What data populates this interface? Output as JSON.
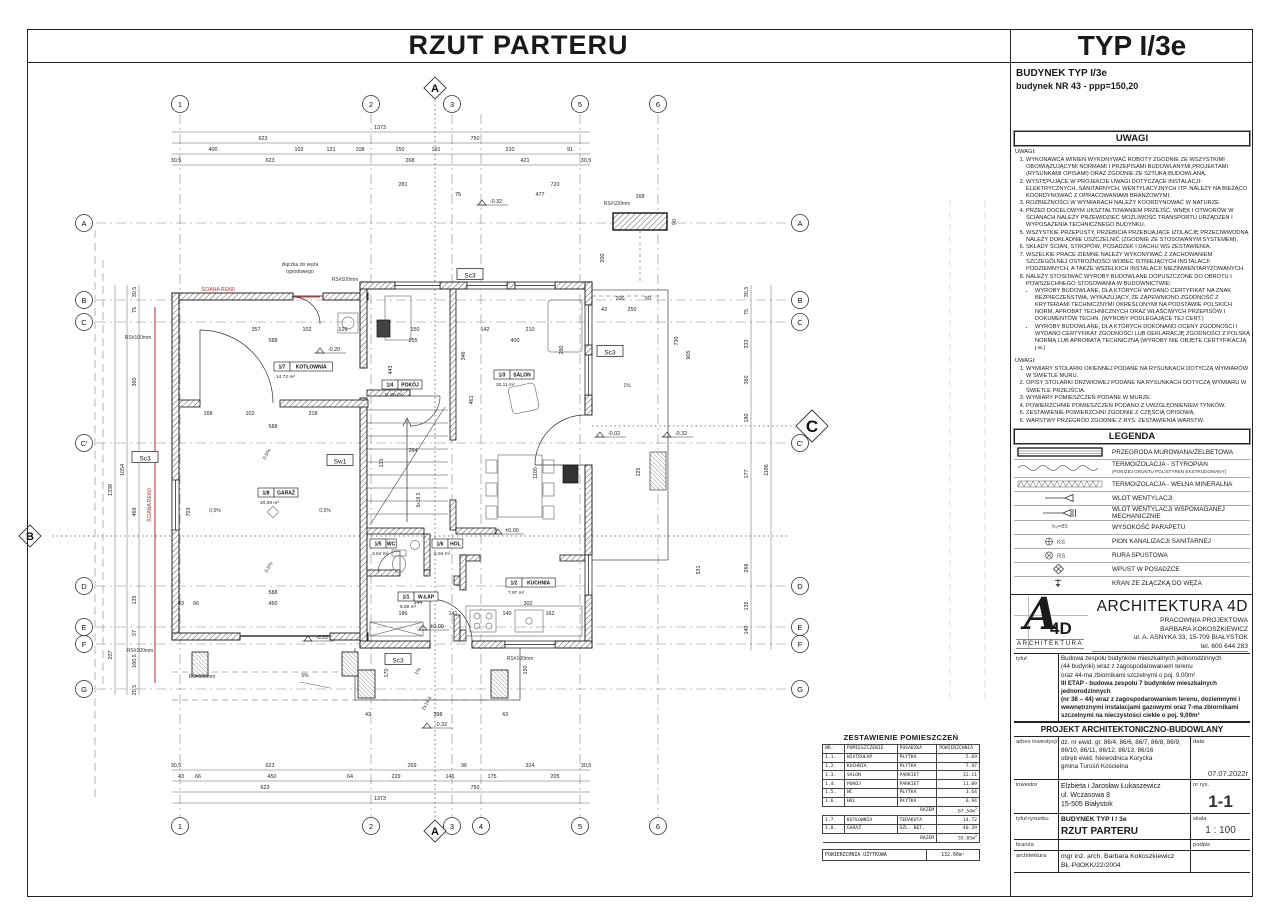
{
  "sheet": {
    "plan_title": "RZUT PARTERU",
    "type_title": "TYP I/3e",
    "building_line1": "BUDYNEK TYP I/3e",
    "building_line2": "budynek NR 43 - ppp=150,20"
  },
  "uwagi1": {
    "header": "UWAGI",
    "intro": "UWAGI:",
    "items": [
      "WYKONAWCA WINIEN WYKONYWAĆ ROBOTY ZGODNIE ZE WSZYSTKIMI OBOWIĄZUJĄCYMI NORMAMI I PRZEPISAMI BUDOWLANYMI,PROJEKTAMI (RYSUNKAMI OPISAMI) ORAZ ZGODNIE ZE SZTUKĄ BUDOWLANĄ.",
      "WYSTĘPUJĄCE W PROJEKCIE UWAGI DOTYCZĄCE INSTALACJI: ELEKTRYCZNYCH, SANITARNYCH, WENTYLACYJNYCH ITP. NALEŻY NA BIEŻĄCO KOORDYNOWAĆ Z OPRACOWANIAMI BRANŻOWYMI.",
      "ROZBIEŻNOŚCI W WYMIARACH NALEŻY KOORDYNOWAĆ W NATURZE.",
      "PRZED DOCELOWYM UKSZTAŁTOWANIEM PRZEJŚĆ, WNĘK I OTWORÓW W ŚCIANACH NALEŻY PRZEWIDZIEĆ MOŻLIWOŚĆ TRANSPORTU URZĄDZEŃ I WYPOSAŻENIA TECHNICZNEGO BUDYNKU.",
      "WSZYSTKIE PRZEPUSTY, PRZEBICIA PRZEBIJAJĄCE IZOLACJĘ PRZECIWWODNĄ NALEŻY DOKŁADNIE USZCZELNIĆ (ZGODNIE ZE STOSOWANYM SYSTEMEM).",
      "SKŁADY ŚCIAN, STROPÓW, POSADZEK I DACHU WG ZESTAWIENIA.",
      "WSZELKIE PRACE ZIEMNE NALEŻY WYKONYWAĆ Z ZACHOWANIEM SZCZEGÓLNEJ OSTROŻNOŚCI WOBEC ISTNIEJĄCYCH INSTALACJI PODZIEMNYCH, A TAKŻE WSZELKICH INSTALACJI NIEZINWENTARYZOWANYCH.",
      "NALEŻY STOSOWAĆ WYROBY BUDOWLANE DOPUSZCZONE DO OBROTU I POWSZECHNEGO STOSOWANIA W BUDOWNICTWIE:"
    ],
    "item8_bullets": [
      "WYROBY BUDOWLANE, DLA KTÓRYCH WYDANO CERTYFIKAT NA ZNAK BEZPIECZEŃSTWA, WYKAZUJĄCY, ŻE ZAPEWNIONO ZGODNOŚĆ Z KRYTERIAMI TECHNICZNYMI OKREŚLONYMI NA PODSTAWIE POLSKICH NORM, APROBAT TECHNICZNYCH ORAZ WŁAŚCIWYCH PRZEPISÓW I DOKUMENTÓW TECHN. (WYROBY PODLEGAJĄCE TEJ CERT.)",
      "WYROBY BUDOWLANE, DLA KTÓRYCH DOKONANO OCENY ZGODNOŚCI I WYDANO CERTYFIKAT ZGODNOŚCI LUB DEKLARACJĘ ZGODNOŚCI Z POLSKĄ NORMĄ LUB APROBATĄ TECHNICZNĄ (WYROBY NIE OBJĘTE CERTYFIKACJĄ j.w.)"
    ]
  },
  "uwagi2": {
    "intro": "UWAGI:",
    "items": [
      "WYMIARY STOLARKI OKIENNEJ PODANE NA RYSUNKACH DOTYCZĄ WYMIARÓW W ŚWIETLE MURU.",
      "OPISY STOLARKI DRZWIOWEJ PODANE NA RYSUNKACH DOTYCZĄ WYMIARU W ŚWIETLE PRZEJŚCIA.",
      "WYMIARY POMIESZCZEŃ PODANE W MURZE.",
      "POWIERZCHNIE POMIESZCZEŃ PODANO Z UWZGLĘDNIENIEM TYNKÓW.",
      "ZESTAWIENIE POWIERZCHNI ZGODNIE Z CZĘŚCIĄ OPISOWĄ.",
      "WARSTWY PRZEGRÓD ZGODNIE Z RYS. ZESTAWIENIA WARSTW."
    ]
  },
  "legend": {
    "header": "LEGENDA",
    "items": [
      {
        "icon": "wall-hatch-icon",
        "label": "PRZEGRODA MUROWANA/ŻELBETOWA",
        "sub": ""
      },
      {
        "icon": "styrofoam-wave-icon",
        "label": "TERMOIZOLACJA - STYROPIAN",
        "sub": "(PONIŻEJ GRUNTU POLISTYREN EKSTRUDOWANY)"
      },
      {
        "icon": "mineral-wool-hatch-icon",
        "label": "TERMOIZOLACJA - WEŁNA MINERALNA",
        "sub": ""
      },
      {
        "icon": "vent-inlet-icon",
        "label": "WLOT WENTYLACJI",
        "sub": ""
      },
      {
        "icon": "vent-inlet-mech-icon",
        "label": "WLOT WENTYLACJI WSPOMAGANEJ MECHANICZNIE",
        "sub": ""
      },
      {
        "icon": "sill-height-icon",
        "symbol_text": "hₚ=85",
        "label": "WYSOKOŚĆ PARAPETU",
        "sub": ""
      },
      {
        "icon": "sanitary-stack-icon",
        "symbol_text": "KS",
        "label": "PION KANALIZACJI SANITARNEJ",
        "sub": ""
      },
      {
        "icon": "downpipe-icon",
        "symbol_text": "RS",
        "label": "RURA SPUSTOWA",
        "sub": ""
      },
      {
        "icon": "floor-drain-icon",
        "label": "WPUST W POSADZCE",
        "sub": ""
      },
      {
        "icon": "hose-tap-icon",
        "label": "KRAN ZE ZŁĄCZKĄ DO WĘŻA",
        "sub": ""
      }
    ]
  },
  "firm": {
    "name": "ARCHITEKTURA 4D",
    "logo_a": "A",
    "logo_4d": "4D",
    "logo_sub": "ARCHITEKTURA",
    "line1": "PRACOWNIA PROJEKTOWA",
    "line2": "BARBARA KOKOSZKIEWICZ",
    "line3": "ul. A. ASNYKA 33, 15-709 BIAŁYSTOK",
    "line4": "tel. 600 644 283"
  },
  "titleblock": {
    "tytul_label": "tytuł",
    "tytul_line1": "Budowa zespołu budynków mieszkalnych jednorodzinnych",
    "tytul_line2": "(44 budynki) wraz z zagospodarowaniem terenu",
    "tytul_line3": "oraz 44-ma zbiornikami szczelnymi o poj. 9,00m³",
    "tytul_line4": "III ETAP - budowa zespołu 7 budynków mieszkalnych jednorodzinnych",
    "tytul_line5": "(nr 38 – 44) wraz z zagospodarowaniem terenu, doziemnymi i",
    "tytul_line6": "wewnętrznymi instalacjami gazowymi oraz 7-ma zbiornikami",
    "tytul_line7": "szczelnymi na nieczystości ciekłe o poj. 9,00m³",
    "projekt_header": "PROJEKT ARCHITEKTONICZNO-BUDOWLANY",
    "adres_label": "adres inwestycji",
    "adres_line1": "dz. nr ewid. gr. 86/4, 86/6, 86/7, 86/8, 86/9,",
    "adres_line2": "86/10, 86/11, 86/12, 86/13, 86/16",
    "adres_line3": "obręb ewid. Niewodnica Korycka",
    "adres_line4": "gmina Turośń Kościelna",
    "data_label": "data",
    "data_value": "07.07.2022r",
    "inwestor_label": "inwestor",
    "inwestor_line1": "Elżbieta i Jarosław Łukaszewicz",
    "inwestor_line2": "ul. Wczasowa 8",
    "inwestor_line3": "15-505 Białystok",
    "nr_label": "nr rys.",
    "nr_value": "1-1",
    "tytul_rys_label": "tytuł rysunku",
    "tytul_rys_line1": "BUDYNEK TYP I / 3e",
    "tytul_rys_line2": "RZUT PARTERU",
    "skala_label": "skala",
    "skala_value": "1 : 100",
    "branza_label": "branża",
    "podpis_label": "podpis",
    "arch_label": "architektura",
    "arch_line1": "mgr inż. arch. Barbara Kokoszkiewicz",
    "arch_line2": "BŁ-PdOKK/22/2004"
  },
  "rooms_table": {
    "title": "ZESTAWIENIE POMIESZCZEŃ",
    "headers": [
      "NR.",
      "POMIESZCZENIE",
      "POSADZKA",
      "POWIERZCHNIA"
    ],
    "rows": [
      [
        "1.1.",
        "WIATROŁAP",
        "PŁYTKA",
        "5.69"
      ],
      [
        "1.2.",
        "KUCHNIA",
        "PŁYTKA",
        "7.97"
      ],
      [
        "1.3.",
        "SALON",
        "PARKIET",
        "32.11"
      ],
      [
        "1.4.",
        "POKÓJ",
        "PARKIET",
        "11.89"
      ],
      [
        "1.5.",
        "WC",
        "PŁYTKA",
        "3.64"
      ],
      [
        "1.6.",
        "HOL",
        "PŁYTKA",
        "6.94"
      ]
    ],
    "razem1_label": "RAZEM",
    "razem1_value": "67.54m²",
    "rows2": [
      [
        "1.7.",
        "KOTŁOWNIA",
        "TERAKOTA",
        "14.72"
      ],
      [
        "1.8.",
        "GARAŻ",
        "SZL. BET.",
        "40.39"
      ]
    ],
    "razem2_label": "RAZEM",
    "razem2_value": "55.85m²",
    "footer_label": "POWIERZCHNIA UŻYTKOWA",
    "footer_value": "132.66m²"
  },
  "plan": {
    "grid_cols": [
      {
        "l": "1",
        "x": 180,
        "top": 1
      },
      {
        "l": "2",
        "x": 371,
        "top": 1
      },
      {
        "l": "3",
        "x": 452,
        "top": 1
      },
      {
        "l": "4",
        "x": 481,
        "top": 0
      },
      {
        "l": "5",
        "x": 580,
        "top": 1
      },
      {
        "l": "6",
        "x": 658,
        "top": 1
      }
    ],
    "grid_rows": [
      {
        "l": "A",
        "y": 223
      },
      {
        "l": "B",
        "y": 300
      },
      {
        "l": "C",
        "y": 322
      },
      {
        "l": "C'",
        "y": 443
      },
      {
        "l": "D",
        "y": 586
      },
      {
        "l": "E",
        "y": 627
      },
      {
        "l": "F",
        "y": 644
      },
      {
        "l": "G",
        "y": 689
      }
    ],
    "sections": [
      {
        "l": "A",
        "x": 435,
        "y": 88
      },
      {
        "l": "A",
        "x": 435,
        "y": 831
      },
      {
        "l": "B",
        "x": 30,
        "y": 536
      },
      {
        "l": "C",
        "x": 812,
        "y": 426,
        "big": 1
      }
    ],
    "rooms": [
      {
        "n": "1/7",
        "name": "KOTŁOWNIA",
        "a": "14.72 m²",
        "x": 274,
        "y": 362
      },
      {
        "n": "1/4",
        "name": "POKÓJ",
        "a": "11.89 m²",
        "x": 382,
        "y": 380
      },
      {
        "n": "1/3",
        "name": "SALON",
        "a": "32.11 m²",
        "x": 494,
        "y": 370
      },
      {
        "n": "1/8",
        "name": "GARAŻ",
        "a": "40.39 m²",
        "x": 258,
        "y": 488
      },
      {
        "n": "1/5",
        "name": "WC",
        "a": "3.64 m²",
        "x": 370,
        "y": 539
      },
      {
        "n": "1/6",
        "name": "HOL",
        "a": "6.94 m²",
        "x": 432,
        "y": 539
      },
      {
        "n": "1/1",
        "name": "W-ŁAP",
        "a": "5.69 m²",
        "x": 398,
        "y": 592
      },
      {
        "n": "1/2",
        "name": "KUCHNIA",
        "a": "7.97 m²",
        "x": 506,
        "y": 578
      }
    ],
    "boxed": [
      {
        "x": 145,
        "y": 458,
        "t": "Sc3"
      },
      {
        "x": 610,
        "y": 352,
        "t": "Sc3"
      },
      {
        "x": 470,
        "y": 275,
        "t": "Sc3"
      },
      {
        "x": 398,
        "y": 660,
        "t": "Sc3"
      },
      {
        "x": 340,
        "y": 461,
        "t": "Sw1"
      }
    ],
    "levels": [
      {
        "x": 492,
        "y": 205,
        "t": "-0.32"
      },
      {
        "x": 330,
        "y": 353,
        "t": "-0.20"
      },
      {
        "x": 610,
        "y": 437,
        "t": "-0.02"
      },
      {
        "x": 677,
        "y": 437,
        "t": "-0.32"
      },
      {
        "x": 508,
        "y": 534,
        "t": "±0.00"
      },
      {
        "x": 433,
        "y": 630,
        "t": "±0.00"
      },
      {
        "x": 318,
        "y": 641,
        "t": "-0.22"
      },
      {
        "x": 437,
        "y": 728,
        "t": "-0.32"
      }
    ],
    "notes": [
      {
        "x": 218,
        "y": 291,
        "t": "ŚCIANA REI60",
        "c": 1
      },
      {
        "x": 151,
        "y": 505,
        "t": "ŚCIANA REI60",
        "c": 1,
        "r": 1
      },
      {
        "x": 300,
        "y": 266,
        "t": "złączka do węża"
      },
      {
        "x": 300,
        "y": 273,
        "t": "ogrodowego"
      },
      {
        "x": 345,
        "y": 281,
        "t": "RS#100mm"
      },
      {
        "x": 138,
        "y": 339,
        "t": "RS#100mm"
      },
      {
        "x": 617,
        "y": 205,
        "t": "RS#100mm"
      },
      {
        "x": 520,
        "y": 660,
        "t": "RS#100mm"
      },
      {
        "x": 140,
        "y": 652,
        "t": "RS#100mm"
      },
      {
        "x": 202,
        "y": 678,
        "t": "RS#100mm"
      },
      {
        "x": 268,
        "y": 455,
        "t": "0,5%",
        "r": 2
      },
      {
        "x": 215,
        "y": 512,
        "t": "0,5%"
      },
      {
        "x": 325,
        "y": 512,
        "t": "0,5%"
      },
      {
        "x": 270,
        "y": 568,
        "t": "0,5%",
        "r": 2
      },
      {
        "x": 305,
        "y": 677,
        "t": "5%"
      },
      {
        "x": 627,
        "y": 387,
        "t": "1%"
      },
      {
        "x": 419,
        "y": 672,
        "t": "1%",
        "r": 2
      },
      {
        "x": 420,
        "y": 500,
        "t": "9x18,5",
        "r": 1
      },
      {
        "x": 428,
        "y": 704,
        "t": "2x16,5",
        "r": 2
      }
    ],
    "dims": [
      {
        "x": 380,
        "y": 129,
        "t": "1373"
      },
      {
        "x": 263,
        "y": 140,
        "t": "623"
      },
      {
        "x": 475,
        "y": 140,
        "t": "750"
      },
      {
        "x": 213,
        "y": 151,
        "t": "400"
      },
      {
        "x": 299,
        "y": 151,
        "t": "102"
      },
      {
        "x": 331,
        "y": 151,
        "t": "121"
      },
      {
        "x": 360,
        "y": 151,
        "t": "108"
      },
      {
        "x": 400,
        "y": 151,
        "t": "150"
      },
      {
        "x": 436,
        "y": 151,
        "t": "191"
      },
      {
        "x": 510,
        "y": 151,
        "t": "210"
      },
      {
        "x": 570,
        "y": 151,
        "t": "91"
      },
      {
        "x": 176,
        "y": 162,
        "t": "30,5"
      },
      {
        "x": 270,
        "y": 162,
        "t": "623"
      },
      {
        "x": 410,
        "y": 162,
        "t": "268"
      },
      {
        "x": 525,
        "y": 162,
        "t": "421"
      },
      {
        "x": 586,
        "y": 162,
        "t": "30,5"
      },
      {
        "x": 403,
        "y": 186,
        "t": "281"
      },
      {
        "x": 555,
        "y": 186,
        "t": "720"
      },
      {
        "x": 458,
        "y": 196,
        "t": "75"
      },
      {
        "x": 540,
        "y": 196,
        "t": "477"
      },
      {
        "x": 640,
        "y": 198,
        "t": "168"
      },
      {
        "x": 676,
        "y": 222,
        "t": "90",
        "r": 1
      },
      {
        "x": 604,
        "y": 258,
        "t": "200",
        "r": 1
      },
      {
        "x": 620,
        "y": 300,
        "t": "200"
      },
      {
        "x": 648,
        "y": 300,
        "t": "50"
      },
      {
        "x": 604,
        "y": 311,
        "t": "43"
      },
      {
        "x": 632,
        "y": 311,
        "t": "250"
      },
      {
        "x": 176,
        "y": 767,
        "t": "30,5"
      },
      {
        "x": 270,
        "y": 767,
        "t": "623"
      },
      {
        "x": 412,
        "y": 767,
        "t": "269"
      },
      {
        "x": 464,
        "y": 767,
        "t": "96"
      },
      {
        "x": 530,
        "y": 767,
        "t": "324"
      },
      {
        "x": 586,
        "y": 767,
        "t": "30,5"
      },
      {
        "x": 181,
        "y": 778,
        "t": "43"
      },
      {
        "x": 198,
        "y": 778,
        "t": "66"
      },
      {
        "x": 272,
        "y": 778,
        "t": "450"
      },
      {
        "x": 350,
        "y": 778,
        "t": "64"
      },
      {
        "x": 396,
        "y": 778,
        "t": "229"
      },
      {
        "x": 450,
        "y": 778,
        "t": "141"
      },
      {
        "x": 492,
        "y": 778,
        "t": "175"
      },
      {
        "x": 555,
        "y": 778,
        "t": "205"
      },
      {
        "x": 265,
        "y": 789,
        "t": "623"
      },
      {
        "x": 475,
        "y": 789,
        "t": "750"
      },
      {
        "x": 380,
        "y": 800,
        "t": "1373"
      },
      {
        "x": 136,
        "y": 292,
        "t": "30,5",
        "r": 1
      },
      {
        "x": 136,
        "y": 310,
        "t": "75",
        "r": 1
      },
      {
        "x": 136,
        "y": 382,
        "t": "360",
        "r": 1
      },
      {
        "x": 136,
        "y": 512,
        "t": "469",
        "r": 1
      },
      {
        "x": 136,
        "y": 600,
        "t": "135",
        "r": 1
      },
      {
        "x": 136,
        "y": 633,
        "t": "57",
        "r": 1
      },
      {
        "x": 136,
        "y": 661,
        "t": "160,5",
        "r": 1
      },
      {
        "x": 136,
        "y": 690,
        "t": "20,5",
        "r": 1
      },
      {
        "x": 124,
        "y": 470,
        "t": "1054",
        "r": 1
      },
      {
        "x": 112,
        "y": 490,
        "t": "1338",
        "r": 1
      },
      {
        "x": 112,
        "y": 655,
        "t": "207",
        "r": 1
      },
      {
        "x": 748,
        "y": 292,
        "t": "30,5",
        "r": 1
      },
      {
        "x": 748,
        "y": 312,
        "t": "75",
        "r": 1
      },
      {
        "x": 748,
        "y": 344,
        "t": "333",
        "r": 1
      },
      {
        "x": 748,
        "y": 380,
        "t": "360",
        "r": 1
      },
      {
        "x": 748,
        "y": 418,
        "t": "180",
        "r": 1
      },
      {
        "x": 748,
        "y": 474,
        "t": "177",
        "r": 1
      },
      {
        "x": 748,
        "y": 568,
        "t": "266",
        "r": 1
      },
      {
        "x": 748,
        "y": 606,
        "t": "135",
        "r": 1
      },
      {
        "x": 748,
        "y": 630,
        "t": "140",
        "r": 1
      },
      {
        "x": 700,
        "y": 570,
        "t": "531",
        "r": 1
      },
      {
        "x": 768,
        "y": 470,
        "t": "1186",
        "r": 1
      },
      {
        "x": 690,
        "y": 355,
        "t": "905",
        "r": 1
      },
      {
        "x": 678,
        "y": 341,
        "t": "730",
        "r": 1
      },
      {
        "x": 640,
        "y": 472,
        "t": "125",
        "r": 1
      },
      {
        "x": 256,
        "y": 331,
        "t": "357"
      },
      {
        "x": 307,
        "y": 331,
        "t": "102"
      },
      {
        "x": 343,
        "y": 331,
        "t": "129"
      },
      {
        "x": 415,
        "y": 331,
        "t": "150"
      },
      {
        "x": 485,
        "y": 331,
        "t": "142"
      },
      {
        "x": 530,
        "y": 331,
        "t": "210"
      },
      {
        "x": 273,
        "y": 342,
        "t": "588"
      },
      {
        "x": 413,
        "y": 342,
        "t": "255"
      },
      {
        "x": 515,
        "y": 342,
        "t": "400"
      },
      {
        "x": 563,
        "y": 350,
        "t": "290",
        "r": 1
      },
      {
        "x": 208,
        "y": 415,
        "t": "168"
      },
      {
        "x": 250,
        "y": 415,
        "t": "102"
      },
      {
        "x": 313,
        "y": 415,
        "t": "318"
      },
      {
        "x": 273,
        "y": 428,
        "t": "588"
      },
      {
        "x": 392,
        "y": 370,
        "t": "443",
        "r": 1
      },
      {
        "x": 465,
        "y": 356,
        "t": "346",
        "r": 1
      },
      {
        "x": 473,
        "y": 400,
        "t": "461",
        "r": 1
      },
      {
        "x": 190,
        "y": 512,
        "t": "703",
        "r": 1
      },
      {
        "x": 383,
        "y": 463,
        "t": "131",
        "r": 1
      },
      {
        "x": 413,
        "y": 452,
        "t": "264"
      },
      {
        "x": 537,
        "y": 473,
        "t": "1100",
        "r": 1
      },
      {
        "x": 273,
        "y": 594,
        "t": "588"
      },
      {
        "x": 273,
        "y": 605,
        "t": "450"
      },
      {
        "x": 181,
        "y": 605,
        "t": "43"
      },
      {
        "x": 196,
        "y": 605,
        "t": "66"
      },
      {
        "x": 418,
        "y": 604,
        "t": "344"
      },
      {
        "x": 403,
        "y": 615,
        "t": "186"
      },
      {
        "x": 453,
        "y": 615,
        "t": "141"
      },
      {
        "x": 507,
        "y": 615,
        "t": "140"
      },
      {
        "x": 550,
        "y": 615,
        "t": "162"
      },
      {
        "x": 528,
        "y": 605,
        "t": "302"
      },
      {
        "x": 438,
        "y": 716,
        "t": "398"
      },
      {
        "x": 368,
        "y": 716,
        "t": "43"
      },
      {
        "x": 505,
        "y": 716,
        "t": "43"
      },
      {
        "x": 388,
        "y": 673,
        "t": "170",
        "r": 1
      },
      {
        "x": 527,
        "y": 670,
        "t": "150",
        "r": 1
      }
    ]
  }
}
